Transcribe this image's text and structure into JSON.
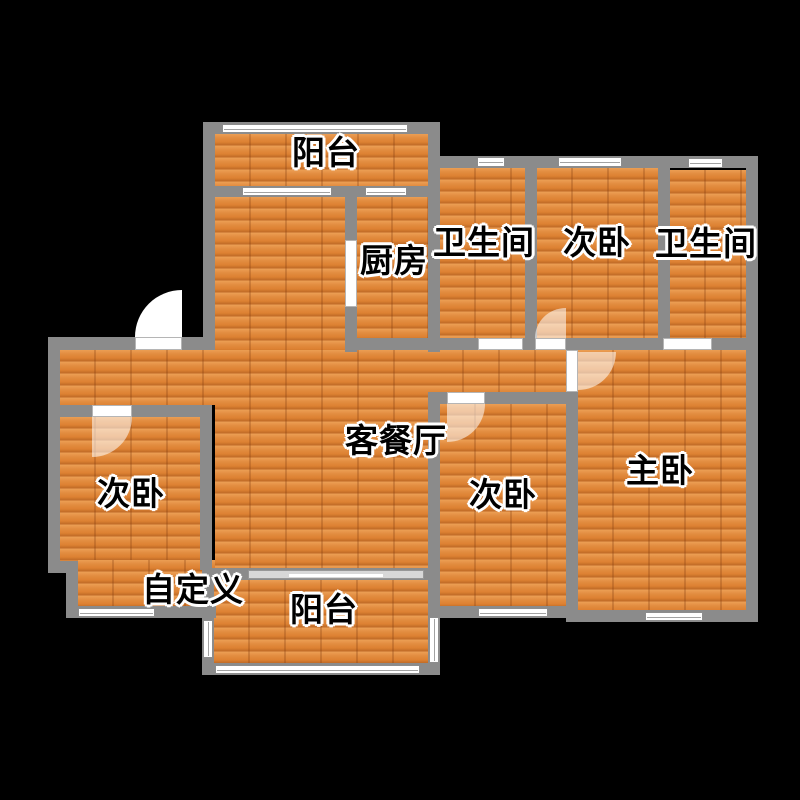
{
  "colors": {
    "background": "#000000",
    "wall": "#8b8b8b",
    "floor_wood": "#e1883b",
    "window": "#ffffff",
    "door_swing": "rgba(255,255,255,0.55)",
    "label_text": "#000000",
    "label_outline": "#ffffff"
  },
  "rooms": {
    "balcony_top": {
      "label": "阳台"
    },
    "kitchen": {
      "label": "厨房"
    },
    "bathroom_left": {
      "label": "卫生间"
    },
    "bedroom_top": {
      "label": "次卧"
    },
    "bathroom_right": {
      "label": "卫生间"
    },
    "living_dining": {
      "label": "客餐厅"
    },
    "bedroom_left": {
      "label": "次卧"
    },
    "custom_area": {
      "label": "自定义"
    },
    "balcony_bottom": {
      "label": "阳台"
    },
    "bedroom_middle": {
      "label": "次卧"
    },
    "master_bedroom": {
      "label": "主卧"
    }
  }
}
